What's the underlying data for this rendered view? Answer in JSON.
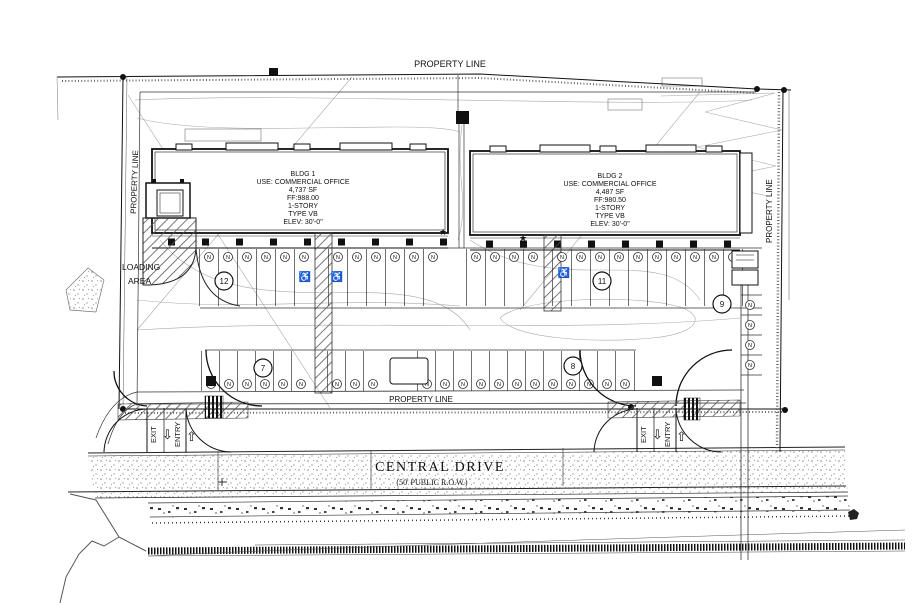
{
  "drawing": {
    "property_line_labels": {
      "top": "PROPERTY LINE",
      "left": "PROPERTY LINE",
      "right": "PROPERTY LINE",
      "middle": "PROPERTY LINE"
    },
    "loading_area": {
      "line1": "LOADING",
      "line2": "AREA"
    },
    "buildings": [
      {
        "name": "BLDG 1",
        "use": "USE: COMMERCIAL OFFICE",
        "area": "4,737 SF",
        "finish_floor": "FF:988.00",
        "stories": "1-STORY",
        "construction_type": "TYPE VB",
        "elevation": "ELEV: 30'-0\""
      },
      {
        "name": "BLDG 2",
        "use": "USE: COMMERCIAL OFFICE",
        "area": "4,487 SF",
        "finish_floor": "FF:980.50",
        "stories": "1-STORY",
        "construction_type": "TYPE VB",
        "elevation": "ELEV: 30'-0\""
      }
    ],
    "street": {
      "name": "CENTRAL DRIVE",
      "row_label": "(50' PUBLIC R.O.W.)"
    },
    "driveway_left": {
      "exit": "EXIT",
      "entry": "ENTRY"
    },
    "driveway_right": {
      "exit": "EXIT",
      "entry": "ENTRY"
    },
    "arrows": {
      "down": "⇩",
      "up": "⇧"
    },
    "symbols": {
      "star": "★"
    },
    "keynotes": [
      "12",
      "11",
      "9",
      "7",
      "8"
    ],
    "accessible": {
      "symbol": "♿",
      "positions": [
        [
          305,
          280
        ],
        [
          337,
          280
        ],
        [
          564,
          276
        ]
      ]
    },
    "parking": {
      "marker": "N",
      "rows": [
        {
          "y": 257,
          "stall_top": 249,
          "stall_bottom": 306,
          "xs": [
            209,
            228,
            247,
            266,
            285,
            304,
            338,
            357,
            376,
            395,
            414,
            433,
            476,
            495,
            514,
            533,
            562,
            581,
            600,
            619,
            638,
            657,
            676,
            695,
            714,
            733
          ]
        },
        {
          "y": 384,
          "stall_top": 351,
          "stall_bottom": 391,
          "xs": [
            211,
            229,
            247,
            265,
            283,
            301,
            337,
            355,
            373,
            427,
            445,
            463,
            481,
            499,
            517,
            535,
            553,
            571,
            589,
            607,
            625
          ]
        }
      ],
      "side": {
        "x": 750,
        "ys": [
          305,
          325,
          345,
          365
        ],
        "stall_left": 741,
        "stall_right": 762
      }
    },
    "colors": {
      "line": "#1a1a1a",
      "light_line": "#999999"
    }
  }
}
